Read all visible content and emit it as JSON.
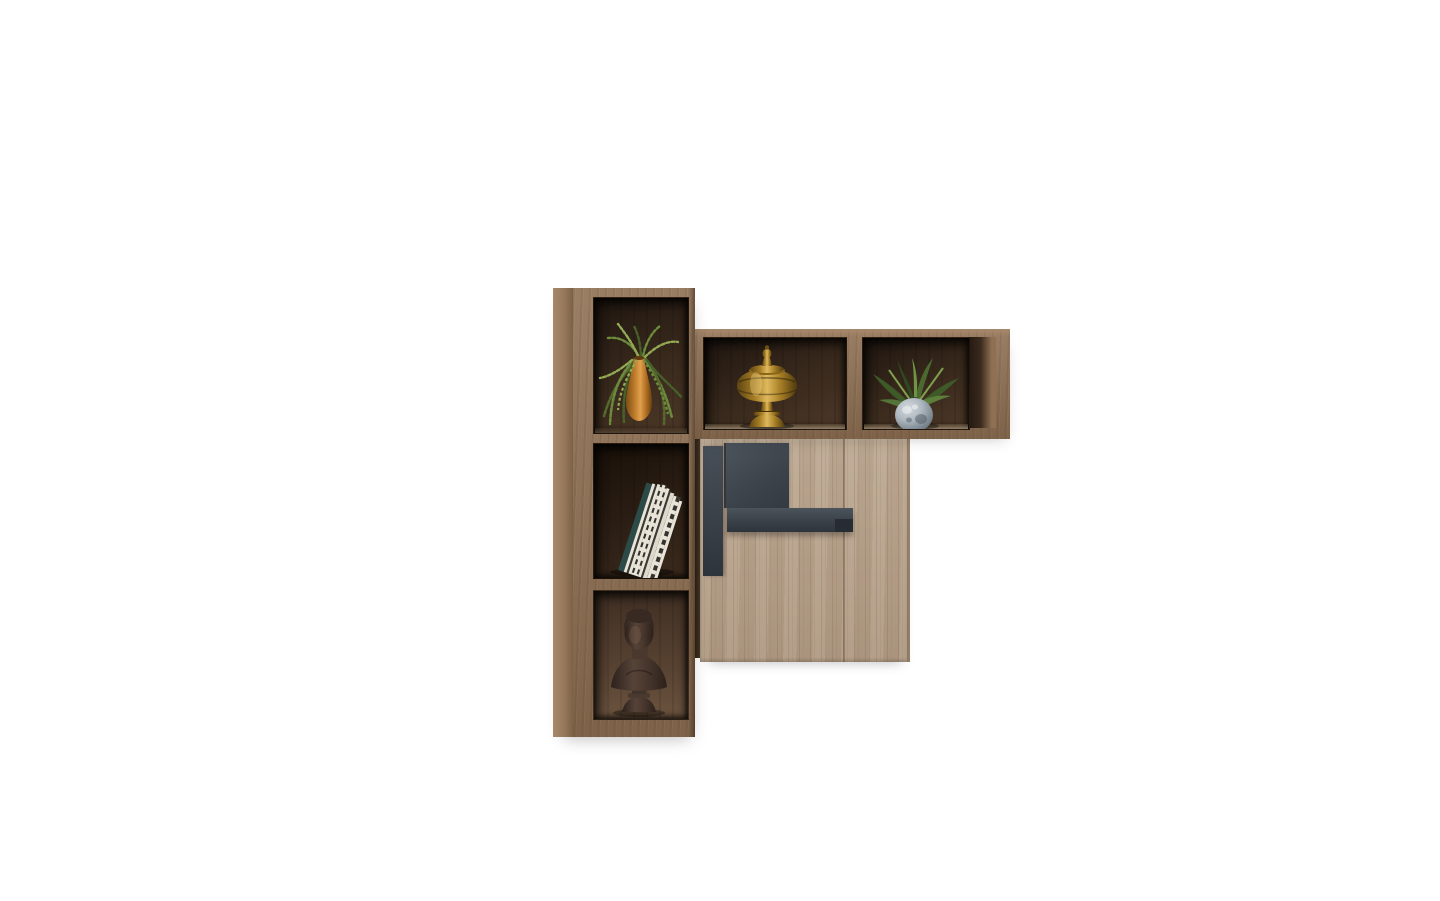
{
  "scene": {
    "type": "product-photo",
    "subject": "wall-mounted-wood-shelf-and-cabinet-set",
    "background": "plain-white"
  },
  "palette": {
    "bg": "#ffffff",
    "walnut_frame": "#8f7053",
    "walnut_frame_light": "#a6886a",
    "walnut_frame_dark": "#5f4631",
    "walnut_side": "#97785c",
    "interior_dark": "#1f1610",
    "interior_mid": "#3a2a1d",
    "interior_warm": "#4c3827",
    "interior_light": "#5d4836",
    "oak_door": "#b5a08b",
    "oak_grain": "#8f755a",
    "oak_light": "#c7b49e",
    "hardware": "#3b434b",
    "hardware_light": "#4b535c",
    "hardware_dark": "#262c32",
    "brass": "#a87f26",
    "brass_light": "#dfb95e",
    "brass_dark": "#5e4512",
    "copper": "#c17e2e",
    "copper_light": "#e0a04c",
    "copper_dark": "#7c4f14",
    "green": "#6c8a3c",
    "green_dark": "#47602a",
    "green_light": "#93aa54",
    "book_page": "#e9e4d8",
    "book_stripe": "#35332f",
    "book_teal": "#2c4b48",
    "bronze": "#46342b",
    "bronze_light": "#614c3f",
    "bronze_dark": "#2f231d",
    "vase_blue": "#8d99a3",
    "vase_blue_light": "#c6cdd2",
    "vase_blue_dark": "#5d6871"
  },
  "decor": {
    "left_column_top": "trailing-plant-in-copper-vase",
    "left_column_middle": "leaning-striped-books",
    "left_column_bottom": "bronze-bust-statue",
    "top_row_left": "brass-urn",
    "top_row_right": "green-plant-in-speckled-vase"
  }
}
